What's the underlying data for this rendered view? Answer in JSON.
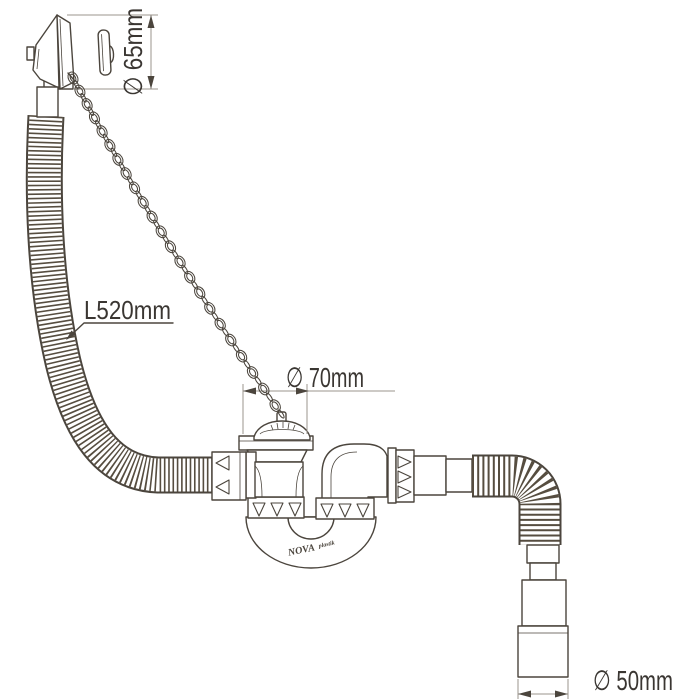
{
  "drawing": {
    "labels": {
      "overflow_diameter": "∅ 65mm",
      "hose_length": "L520mm",
      "drain_diameter": "∅ 70mm",
      "outlet_diameter": "∅ 50mm"
    },
    "brand": {
      "name": "NOVA",
      "suffix": "plastik"
    },
    "colors": {
      "line": "#4b453d",
      "rib": "#564d40",
      "dim": "#9b958c",
      "text": "#3a3632",
      "bg": "#ffffff"
    }
  }
}
